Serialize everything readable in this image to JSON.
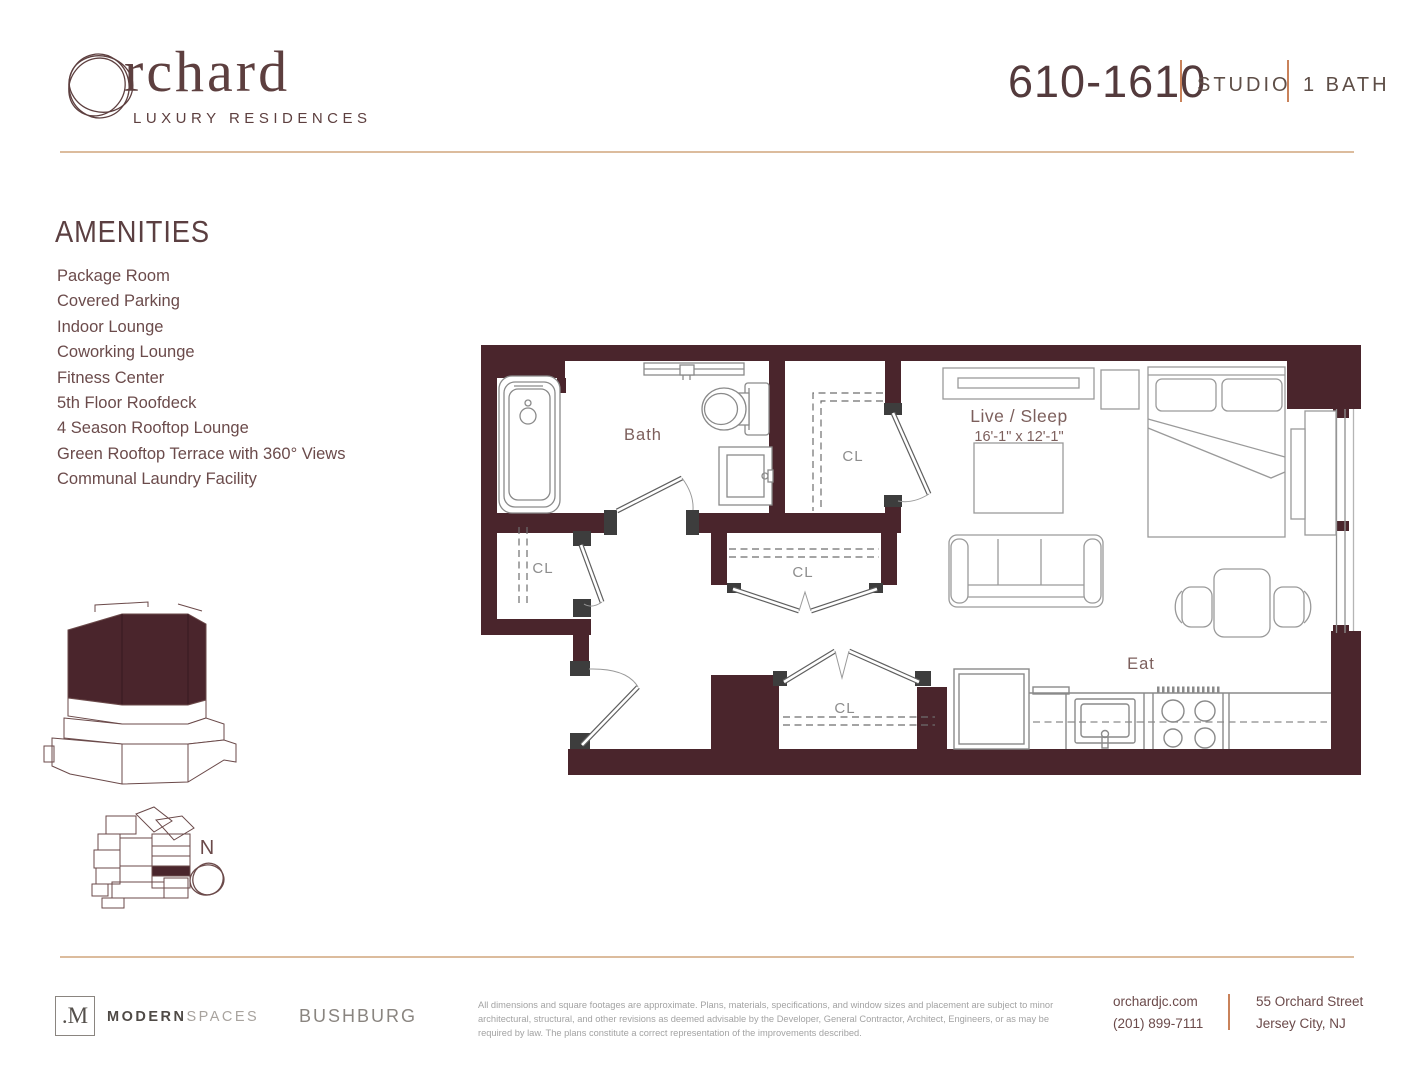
{
  "brand": {
    "logo_text": "rchard",
    "tagline": "LUXURY RESIDENCES"
  },
  "unit_header": {
    "unit": "610-1610",
    "type": "STUDIO",
    "bath": "1 BATH"
  },
  "amenities": {
    "heading": "AMENITIES",
    "items": [
      "Package Room",
      "Covered Parking",
      "Indoor Lounge",
      "Coworking Lounge",
      "Fitness Center",
      "5th Floor Roofdeck",
      "4 Season Rooftop Lounge",
      "Green Rooftop Terrace with 360° Views",
      "Communal Laundry Facility"
    ]
  },
  "floorplan": {
    "labels": {
      "bath": "Bath",
      "closet": "CL",
      "live_sleep": "Live / Sleep",
      "live_sleep_dims": "16'-1\" x 12'-1\"",
      "eat": "Eat"
    },
    "compass": "N"
  },
  "footer": {
    "brokerage": {
      "monogram": ".M",
      "name_bold": "MODERN",
      "name_light": "SPACES"
    },
    "developer": "BUSHBURG",
    "disclaimer": "All dimensions and square footages are approximate. Plans, materials, specifications, and window sizes and placement are subject to minor architectural, structural, and other revisions as deemed advisable by the Developer, General Contractor, Architect, Engineers, or as may be required by law. The plans constitute a correct representation of the improvements described.",
    "website": "orchardjc.com",
    "phone": "(201) 899-7111",
    "address_line1": "55 Orchard Street",
    "address_line2": "Jersey City, NJ"
  },
  "colors": {
    "wall": "#4a252c",
    "brand": "#5d3f3f",
    "accent_tan": "#dcbc9d",
    "accent_orange": "#c9825a",
    "amenity_text": "#6b4b4b",
    "room_label": "#7c5f5c",
    "closet_label": "#8d8d8d",
    "footer_gray": "#8a8580",
    "disclaimer_gray": "#a3a3a3"
  }
}
